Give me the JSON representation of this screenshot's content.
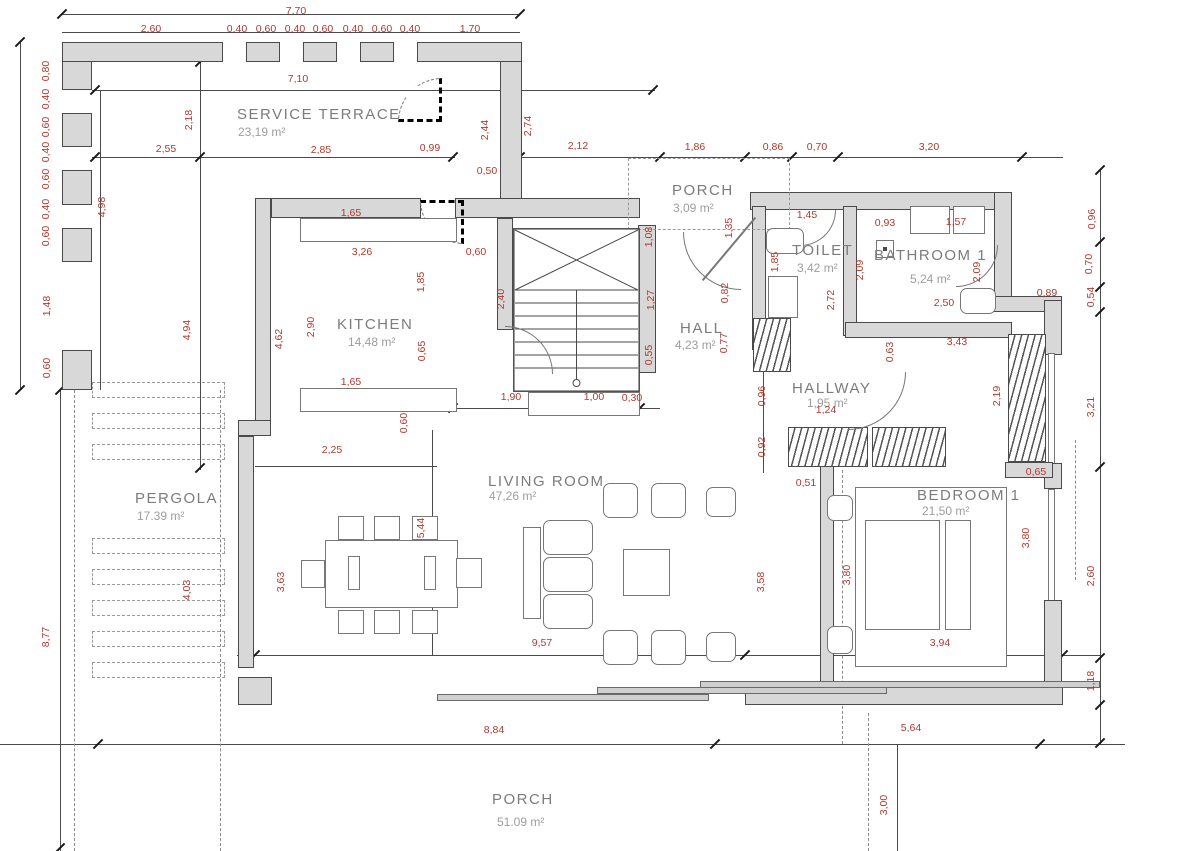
{
  "plan": {
    "title": "floor-plan",
    "accent_red": "#b0392e",
    "wall_gray": "#d8d8d8",
    "rooms": [
      {
        "name": "SERVICE TERRACE",
        "area": "23,19 m²",
        "x": 237,
        "y": 106,
        "ax": 238,
        "ay": 125
      },
      {
        "name": "PORCH",
        "area": "3,09 m²",
        "x": 672,
        "y": 182,
        "ax": 673,
        "ay": 201
      },
      {
        "name": "TOILET",
        "area": "3,42 m²",
        "x": 792,
        "y": 242,
        "ax": 797,
        "ay": 261
      },
      {
        "name": "BATHROOM 1",
        "area": "5,24 m²",
        "x": 874,
        "y": 247,
        "ax": 910,
        "ay": 272
      },
      {
        "name": "KITCHEN",
        "area": "14,48 m²",
        "x": 337,
        "y": 316,
        "ax": 348,
        "ay": 335
      },
      {
        "name": "HALL",
        "area": "4,23 m²",
        "x": 680,
        "y": 320,
        "ax": 675,
        "ay": 338
      },
      {
        "name": "HALLWAY",
        "area": "1,95 m²",
        "x": 792,
        "y": 380,
        "ax": 807,
        "ay": 396
      },
      {
        "name": "PERGOLA",
        "area": "17.39 m²",
        "x": 135,
        "y": 490,
        "ax": 137,
        "ay": 509
      },
      {
        "name": "LIVING ROOM",
        "area": "47,26 m²",
        "x": 488,
        "y": 473,
        "ax": 489,
        "ay": 489
      },
      {
        "name": "BEDROOM 1",
        "area": "21,50 m²",
        "x": 917,
        "y": 487,
        "ax": 922,
        "ay": 504
      },
      {
        "name": "PORCH",
        "area": "51.09 m²",
        "x": 492,
        "y": 791,
        "ax": 497,
        "ay": 815
      }
    ],
    "dimensions": [
      [
        "7,70",
        296,
        11,
        0
      ],
      [
        "2,60",
        151,
        29,
        0
      ],
      [
        "0,40",
        237,
        29,
        0
      ],
      [
        "0,60",
        266,
        29,
        0
      ],
      [
        "0,40",
        295,
        29,
        0
      ],
      [
        "0,60",
        323,
        29,
        0
      ],
      [
        "0,40",
        353,
        29,
        0
      ],
      [
        "0,60",
        382,
        29,
        0
      ],
      [
        "0,40",
        410,
        29,
        0
      ],
      [
        "1,70",
        470,
        29,
        0
      ],
      [
        "7,10",
        298,
        79,
        0
      ],
      [
        "0,80",
        46,
        71,
        1
      ],
      [
        "0,40",
        46,
        99,
        1
      ],
      [
        "0,60",
        46,
        127,
        1
      ],
      [
        "0,40",
        46,
        152,
        1
      ],
      [
        "0,60",
        46,
        179,
        1
      ],
      [
        "0,40",
        46,
        209,
        1
      ],
      [
        "0,60",
        46,
        236,
        1
      ],
      [
        "1,48",
        47,
        306,
        1
      ],
      [
        "0,60",
        47,
        368,
        1
      ],
      [
        "8,77",
        46,
        637,
        1
      ],
      [
        "4,98",
        102,
        207,
        1
      ],
      [
        "2,18",
        189,
        120,
        1
      ],
      [
        "4,94",
        187,
        330,
        1
      ],
      [
        "2,55",
        166,
        149,
        0
      ],
      [
        "2,85",
        321,
        150,
        0
      ],
      [
        "0,99",
        430,
        148,
        0
      ],
      [
        "2,44",
        485,
        130,
        1
      ],
      [
        "0,50",
        487,
        171,
        0
      ],
      [
        "2,74",
        528,
        126,
        1
      ],
      [
        "2,12",
        578,
        146,
        0
      ],
      [
        "1,86",
        695,
        147,
        0
      ],
      [
        "0,86",
        773,
        147,
        0
      ],
      [
        "0,70",
        817,
        147,
        0
      ],
      [
        "3,20",
        929,
        147,
        0
      ],
      [
        "1,65",
        351,
        213,
        0
      ],
      [
        "3,26",
        362,
        252,
        0
      ],
      [
        "0,60",
        476,
        252,
        0
      ],
      [
        "1,85",
        421,
        282,
        1
      ],
      [
        "2,90",
        311,
        327,
        1
      ],
      [
        "4,62",
        279,
        339,
        1
      ],
      [
        "0,65",
        422,
        351,
        1
      ],
      [
        "1,65",
        351,
        382,
        0
      ],
      [
        "0,60",
        404,
        423,
        1
      ],
      [
        "2,25",
        332,
        450,
        0
      ],
      [
        "2,40",
        501,
        299,
        1
      ],
      [
        "1,90",
        511,
        397,
        0
      ],
      [
        "1,00",
        594,
        397,
        0
      ],
      [
        "0,30",
        632,
        398,
        0
      ],
      [
        "1,08",
        649,
        237,
        1
      ],
      [
        "1,27",
        651,
        300,
        1
      ],
      [
        "0,55",
        649,
        355,
        1
      ],
      [
        "1,35",
        729,
        228,
        1
      ],
      [
        "1,85",
        775,
        262,
        1
      ],
      [
        "0,82",
        725,
        293,
        1
      ],
      [
        "0,77",
        724,
        343,
        1
      ],
      [
        "1,45",
        807,
        215,
        0
      ],
      [
        "2,09",
        860,
        270,
        1
      ],
      [
        "2,72",
        831,
        300,
        1
      ],
      [
        "0,93",
        885,
        223,
        0
      ],
      [
        "1,57",
        956,
        222,
        0
      ],
      [
        "2,09",
        977,
        272,
        1
      ],
      [
        "2,50",
        944,
        303,
        0
      ],
      [
        "3,43",
        957,
        342,
        0
      ],
      [
        "0,63",
        890,
        352,
        1
      ],
      [
        "0,96",
        762,
        396,
        1
      ],
      [
        "0,92",
        762,
        447,
        1
      ],
      [
        "1,24",
        826,
        410,
        0
      ],
      [
        "0,96",
        1092,
        219,
        1
      ],
      [
        "0,70",
        1089,
        264,
        1
      ],
      [
        "0,54",
        1091,
        297,
        1
      ],
      [
        "0,89",
        1047,
        293,
        0
      ],
      [
        "3,21",
        1091,
        407,
        1
      ],
      [
        "2,19",
        997,
        396,
        1
      ],
      [
        "0,51",
        806,
        483,
        0
      ],
      [
        "0,65",
        1036,
        472,
        0
      ],
      [
        "3,80",
        847,
        575,
        1
      ],
      [
        "3,80",
        1026,
        538,
        1
      ],
      [
        "3,94",
        940,
        643,
        0
      ],
      [
        "5,44",
        421,
        528,
        1
      ],
      [
        "3,63",
        281,
        582,
        1
      ],
      [
        "4,03",
        187,
        590,
        1
      ],
      [
        "9,57",
        542,
        643,
        0
      ],
      [
        "3,58",
        761,
        582,
        1
      ],
      [
        "8,84",
        494,
        730,
        0
      ],
      [
        "5,64",
        911,
        728,
        0
      ],
      [
        "2,60",
        1091,
        576,
        1
      ],
      [
        "1,18",
        1091,
        681,
        1
      ],
      [
        "3,00",
        884,
        805,
        1
      ]
    ]
  }
}
